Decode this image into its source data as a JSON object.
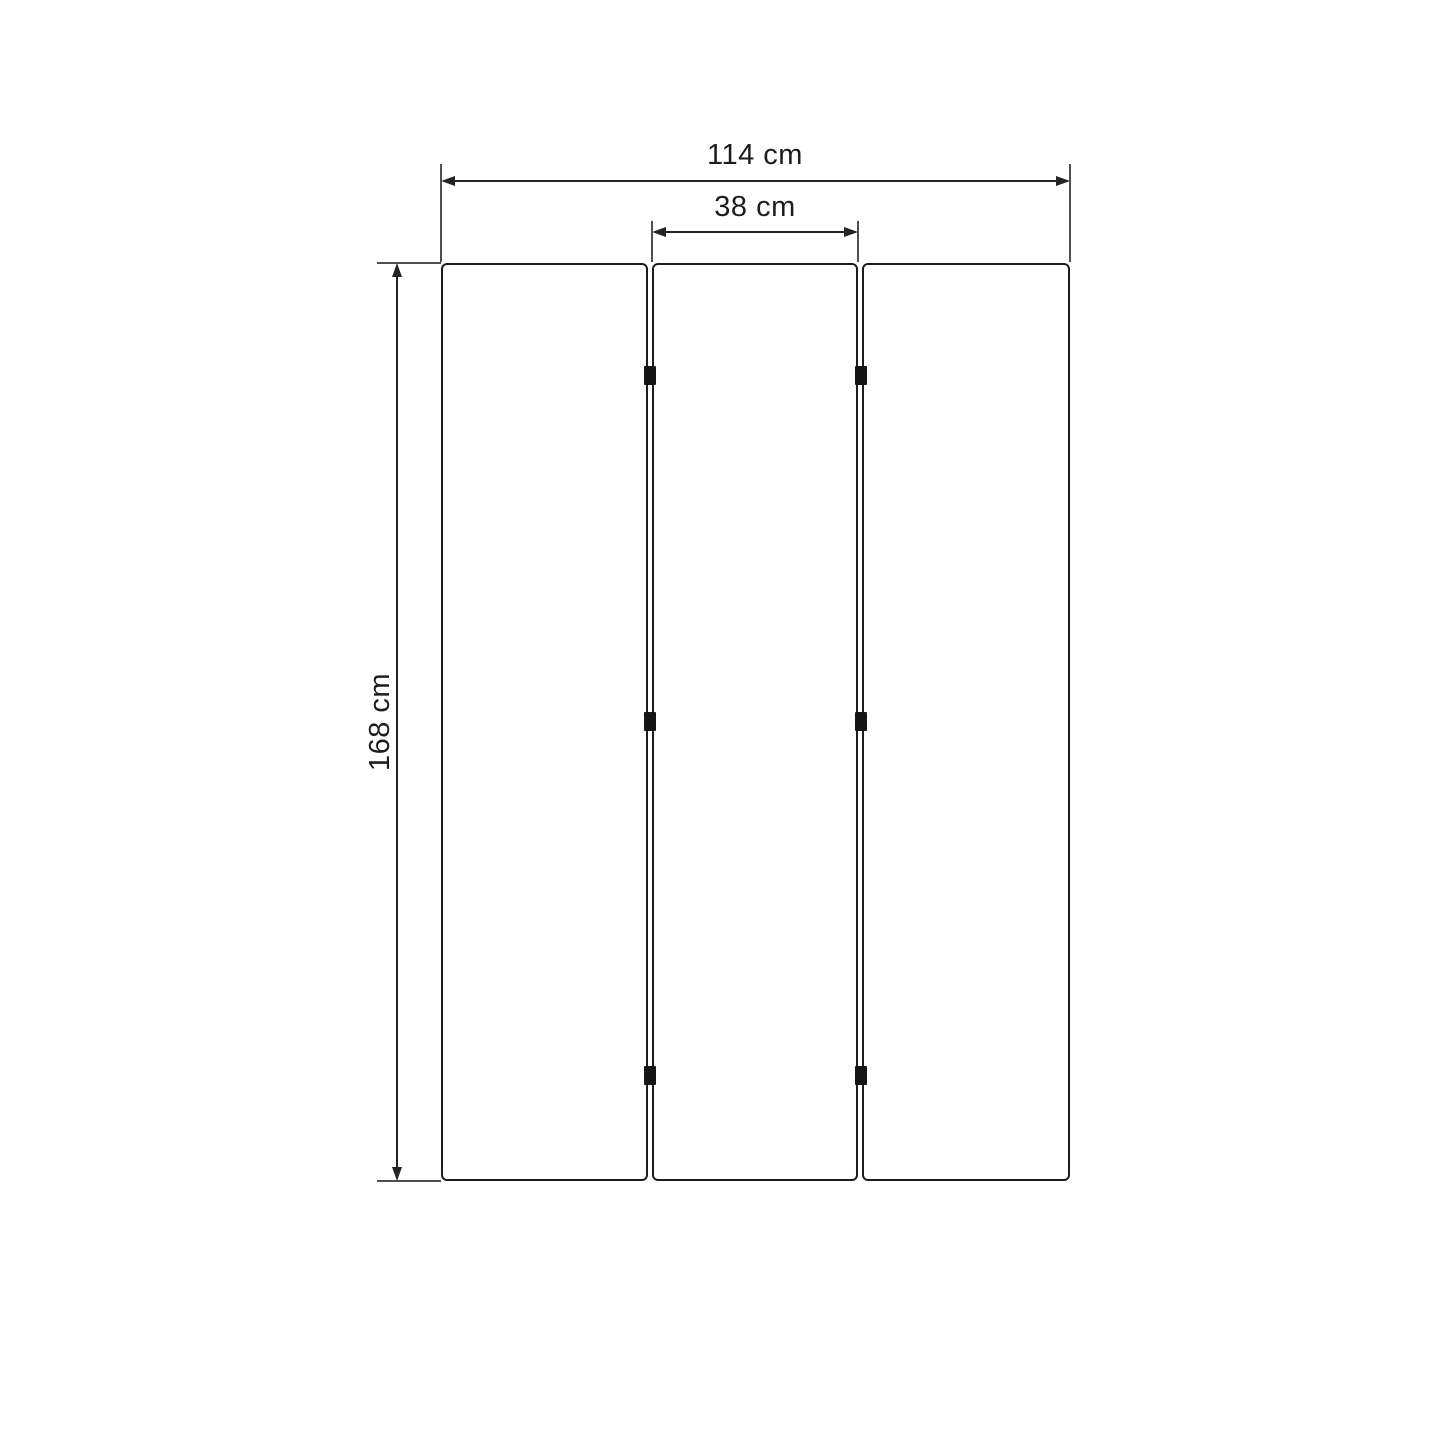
{
  "diagram": {
    "type": "furniture-dimension-drawing",
    "subject": "three-panel folding screen, front view",
    "unit": "cm",
    "panel_count": 3,
    "hinges_per_gap": 3,
    "dimensions": {
      "total_width": {
        "value": 114,
        "unit": "cm",
        "label": "114 cm"
      },
      "panel_width": {
        "value": 38,
        "unit": "cm",
        "label": "38 cm"
      },
      "height": {
        "value": 168,
        "unit": "cm",
        "label": "168 cm"
      }
    },
    "colors": {
      "background": "#ffffff",
      "panel_border": "#1d1d1f",
      "dimension_line": "#242424",
      "extension_line": "#4f4f4f",
      "hinge": "#151517",
      "text": "#1d1d1f"
    }
  }
}
